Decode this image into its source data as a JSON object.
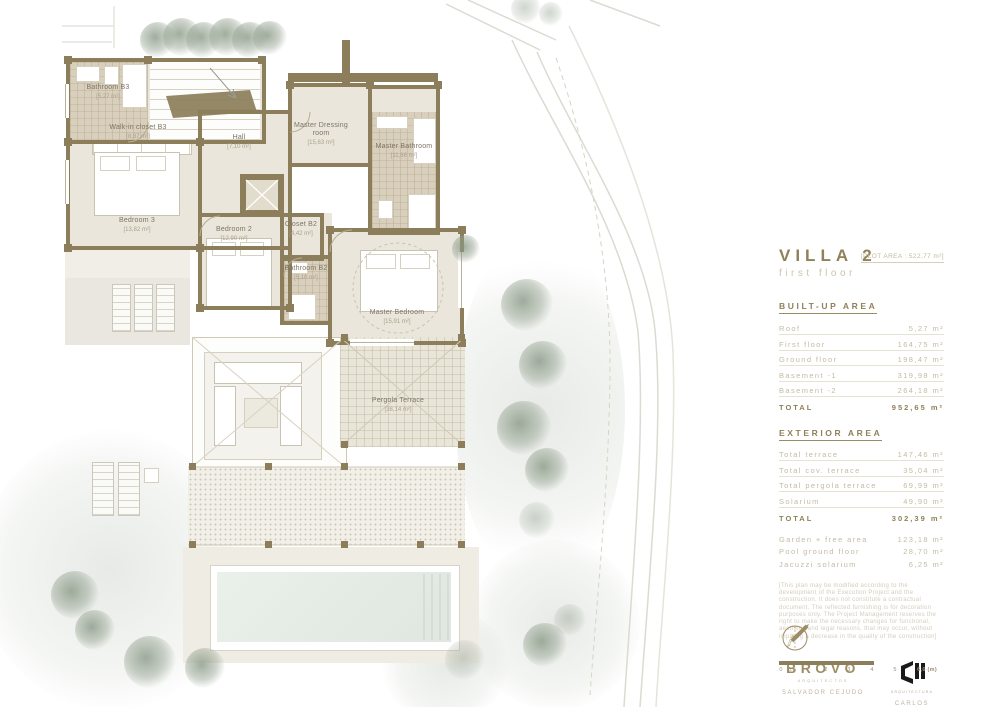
{
  "panel": {
    "title": "VILLA 2",
    "subtitle": "first floor",
    "plot_area": "[PLOT AREA : 522,77 m²]",
    "built_up": {
      "heading": "BUILT-UP AREA",
      "rows": [
        {
          "label": "Roof",
          "value": "5,27 m²"
        },
        {
          "label": "First floor",
          "value": "164,75 m²"
        },
        {
          "label": "Ground floor",
          "value": "198,47 m²"
        },
        {
          "label": "Basement -1",
          "value": "319,98 m²"
        },
        {
          "label": "Basement -2",
          "value": "264,18 m²"
        }
      ],
      "total": {
        "label": "TOTAL",
        "value": "952,65 m²"
      }
    },
    "exterior": {
      "heading": "EXTERIOR AREA",
      "rows": [
        {
          "label": "Total terrace",
          "value": "147,46 m²"
        },
        {
          "label": "Total cov. terrace",
          "value": "35,04 m²"
        },
        {
          "label": "Total pergola terrace",
          "value": "69,99 m²"
        },
        {
          "label": "Solarium",
          "value": "49,90 m²"
        }
      ],
      "total": {
        "label": "TOTAL",
        "value": "302,39 m²"
      },
      "extra_rows": [
        {
          "label": "Garden + free area",
          "value": "123,18 m²"
        },
        {
          "label": "Pool ground floor",
          "value": "28,70 m²"
        },
        {
          "label": "Jacuzzi solarium",
          "value": "6,25 m²"
        }
      ]
    },
    "disclaimer": "[This plan may be modified according to the development of the Execution Project and the construction. It does not constitute a contractual document. The reflected furnishing is for decoration purposes only. The Project Management reserves the right to make the necessary changes for functional, aesthetic and legal reasons, that may occur, without implying a decrease in the quality of the construction]",
    "logos": {
      "brovo": {
        "name": "BRŌVO",
        "tagline": "ARQUITECTOS",
        "person": "SALVADOR CEJUDO"
      },
      "cm": {
        "tagline": "ARQUITECTURA",
        "person": "CARLOS MORALES"
      }
    },
    "compass_label": "NORTE",
    "scale": {
      "ticks": [
        "0",
        "0.5",
        "1",
        "2",
        "3",
        "4",
        "5"
      ],
      "end_label": "6,6 (m)"
    }
  },
  "plan": {
    "rooms": [
      {
        "name": "Bathroom B3",
        "area": "[5,27 m²]"
      },
      {
        "name": "Walk-in closet B3",
        "area": "[8,87 m²]"
      },
      {
        "name": "Hall",
        "area": "[7,10 m²]"
      },
      {
        "name": "Master Dressing room",
        "area": "[15,63 m²]"
      },
      {
        "name": "Master Bathroom",
        "area": "[11,66 m²]"
      },
      {
        "name": "Bedroom 3",
        "area": "[13,82 m²]"
      },
      {
        "name": "Bedroom 2",
        "area": "[12,90 m²]"
      },
      {
        "name": "Closet B2",
        "area": "[4,42 m²]"
      },
      {
        "name": "Bathroom B2",
        "area": "[5,10 m²]"
      },
      {
        "name": "Master Bedroom",
        "area": "[15,91 m²]"
      },
      {
        "name": "Pergola Terrace",
        "area": "[38,14 m²]"
      }
    ]
  },
  "colors": {
    "accent": "#8f8159",
    "muted": "#c3bba4",
    "wall": "#8c7e5a",
    "tree": "#96a390",
    "water": "#e4ebe4"
  }
}
